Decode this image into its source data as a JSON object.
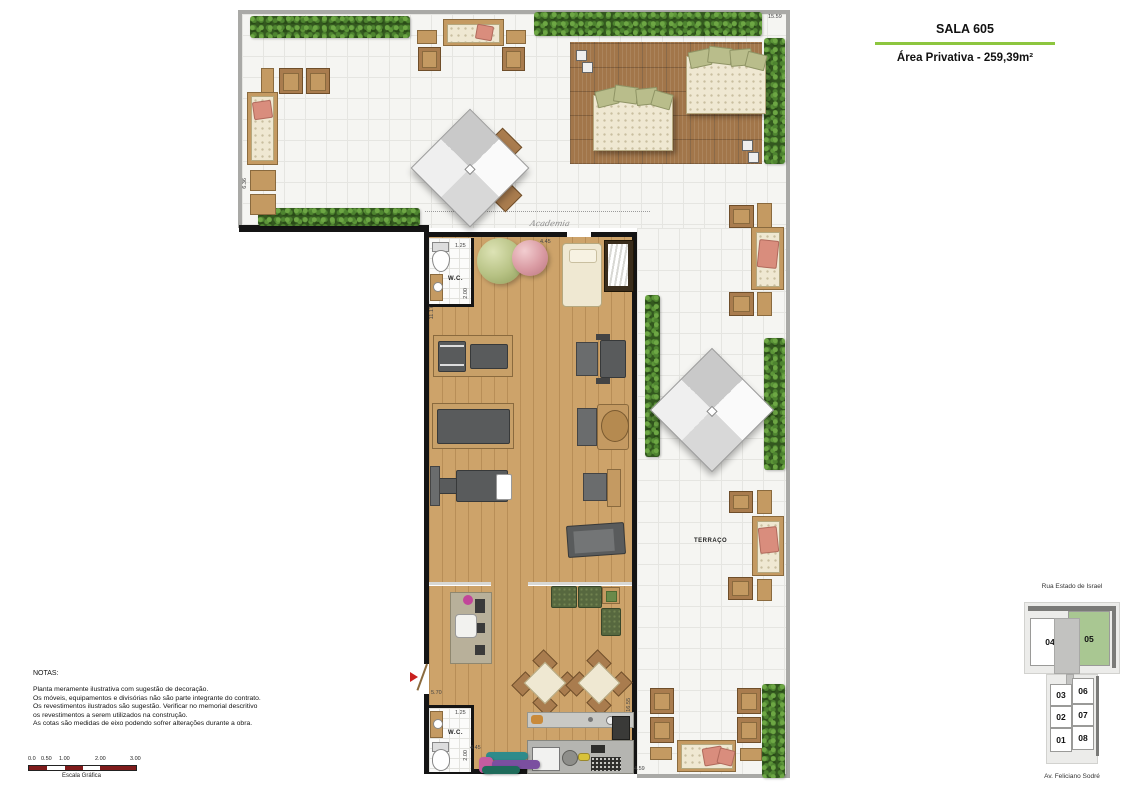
{
  "header": {
    "title": "SALA 605",
    "subtitle": "Área Privativa - 259,39m²"
  },
  "plan": {
    "terrace_label": "TERRAÇO",
    "wc1_label": "W.C.",
    "wc2_label": "W.C.",
    "signature": "Academia",
    "dims": {
      "top_width": "15.59",
      "left_height": "6.36",
      "room_top": "4.45",
      "wc1_width": "1.25",
      "wc1_height": "2.00",
      "left_wall": "11.17",
      "entry": "5.70",
      "room_bottom": "4.45",
      "wc2_width": "1.25",
      "wc2_height": "2.00",
      "right_wall": "16.55",
      "bottom_right": "4.59"
    }
  },
  "notes": {
    "heading": "NOTAS:",
    "lines": [
      "Planta meramente ilustrativa com sugestão de decoração.",
      "Os móveis, equipamentos e divisórias não são parte integrante do contrato.",
      "Os revestimentos ilustrados são sugestão. Verificar no memorial descritivo",
      "os revestimentos a serem utilizados na construção.",
      "As cotas são medidas de eixo podendo sofrer alterações durante a obra."
    ]
  },
  "scale_bar": {
    "ticks": [
      "0.0",
      "0.50",
      "1.00",
      "2.00",
      "3.00"
    ],
    "caption": "Escala Gráfica"
  },
  "key_map": {
    "street_top": "Rua Estado de Israel",
    "street_bottom": "Av. Feliciano Sodré",
    "highlighted_unit": "05",
    "units": {
      "u04": "04",
      "u05": "05",
      "u03": "03",
      "u06": "06",
      "u02": "02",
      "u07": "07",
      "u01": "01",
      "u08": "08"
    }
  },
  "colors": {
    "accent_green": "#8dc63f",
    "map_highlight": "#a9c792",
    "scale_red": "#7f1b1b"
  }
}
